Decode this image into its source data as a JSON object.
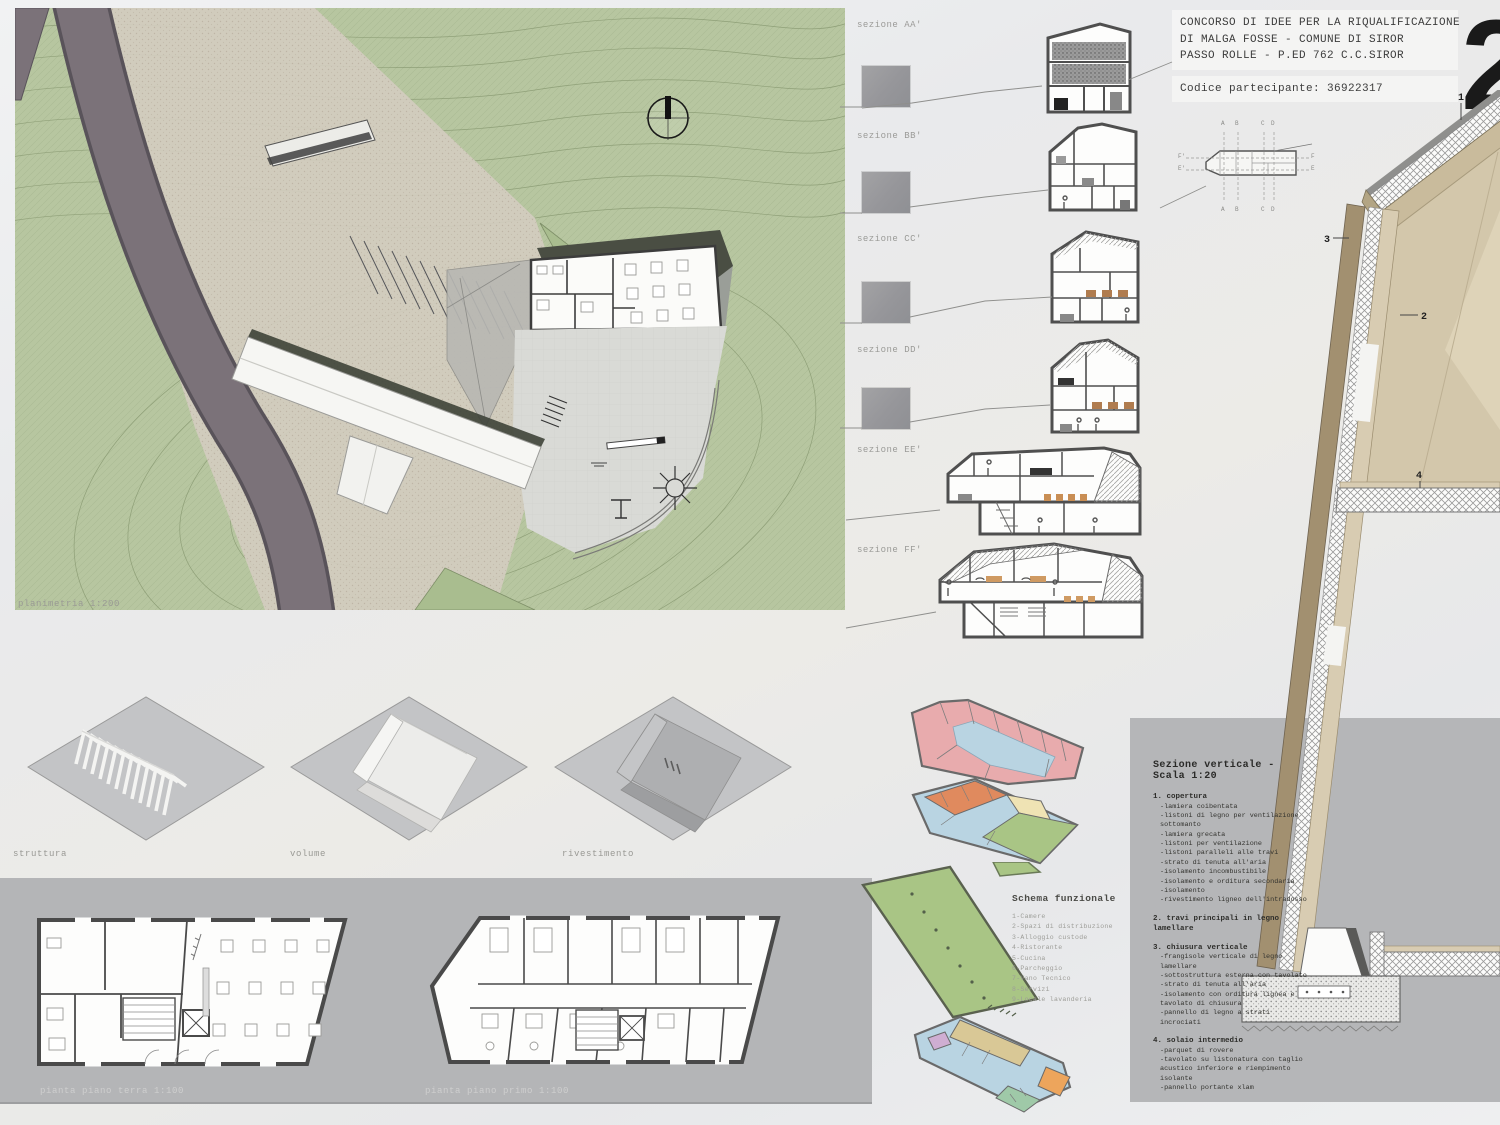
{
  "header": {
    "title_line1": "CONCORSO DI IDEE PER LA RIQUALIFICAZIONE",
    "title_line2": "DI MALGA FOSSE - COMUNE DI SIROR",
    "title_line3": "PASSO ROLLE - P.ED 762 C.C.SIROR",
    "participant_code": "Codice partecipante: 36922317",
    "board_number": "2"
  },
  "site_plan": {
    "caption": "planimetria 1:200"
  },
  "massing_diagrams": {
    "labels": [
      "struttura",
      "volume",
      "rivestimento"
    ]
  },
  "floor_plans": {
    "captions": [
      "pianta piano terra 1:100",
      "pianta piano primo 1:100"
    ]
  },
  "sections": {
    "labels": [
      "sezione AA'",
      "sezione BB'",
      "sezione CC'",
      "sezione DD'",
      "sezione EE'",
      "sezione FF'"
    ]
  },
  "key_plan": {
    "top": [
      "A",
      "B",
      "C",
      "D"
    ],
    "bottom": [
      "A",
      "B",
      "C",
      "D"
    ],
    "left": [
      "F'",
      "E'"
    ],
    "right": [
      "F",
      "E"
    ]
  },
  "detail_legend": {
    "title": "Sezione verticale - Scala 1:20",
    "callouts": [
      "1",
      "2",
      "3",
      "4"
    ],
    "items": [
      {
        "label": "1. copertura",
        "sub": [
          "-lamiera coibentata",
          "-listoni di legno per ventilazione sottomanto",
          "-lamiera grecata",
          "-listoni  per ventilazione",
          "-listoni paralleli alle travi",
          "-strato di tenuta all'aria",
          "-isolamento incombustibile",
          "-isolamento e orditura secondaria",
          "-isolamento",
          "-rivestimento ligneo dell'intradosso"
        ]
      },
      {
        "label": "2. travi principali in legno lamellare",
        "sub": []
      },
      {
        "label": "3. chiusura verticale",
        "sub": [
          "-frangisole verticale di legno lamellare",
          "-sottostruttura esterna con tavolato",
          "-strato di tenuta all'aria",
          "-isolamento con orditura lignea e tavolato di chiusura",
          "-pannello di legno a strati incrociati"
        ]
      },
      {
        "label": "4. solaio intermedio",
        "sub": [
          "-parquet di rovere",
          "-tavolato su listonatura con taglio acustico inferiore e riempimento isolante",
          "-pannello portante xlam"
        ]
      }
    ]
  },
  "schema_funzionale": {
    "title": "Schema funzionale",
    "items": [
      "1-Camere",
      "2-Spazi di distribuzione",
      "3-Alloggio custode",
      "4-Ristorante",
      "5-Cucina",
      "6-Parcheggio",
      "7-Vano Tecnico",
      "8-Servizi",
      "9-Locale lavanderia"
    ]
  },
  "colors": {
    "terrain_green": "#b7c6a0",
    "road_gray": "#7b7279",
    "panel_gray": "#b5b6b8",
    "wood_tan": "#d3c7ab",
    "wood_dark": "#a29070",
    "plan_pink": "#e8abad",
    "plan_blue": "#b9d4e2",
    "plan_orange": "#e08a5e",
    "plan_cream": "#efe3b4",
    "plan_green": "#a9c585",
    "plan_purple": "#cfaed2"
  }
}
